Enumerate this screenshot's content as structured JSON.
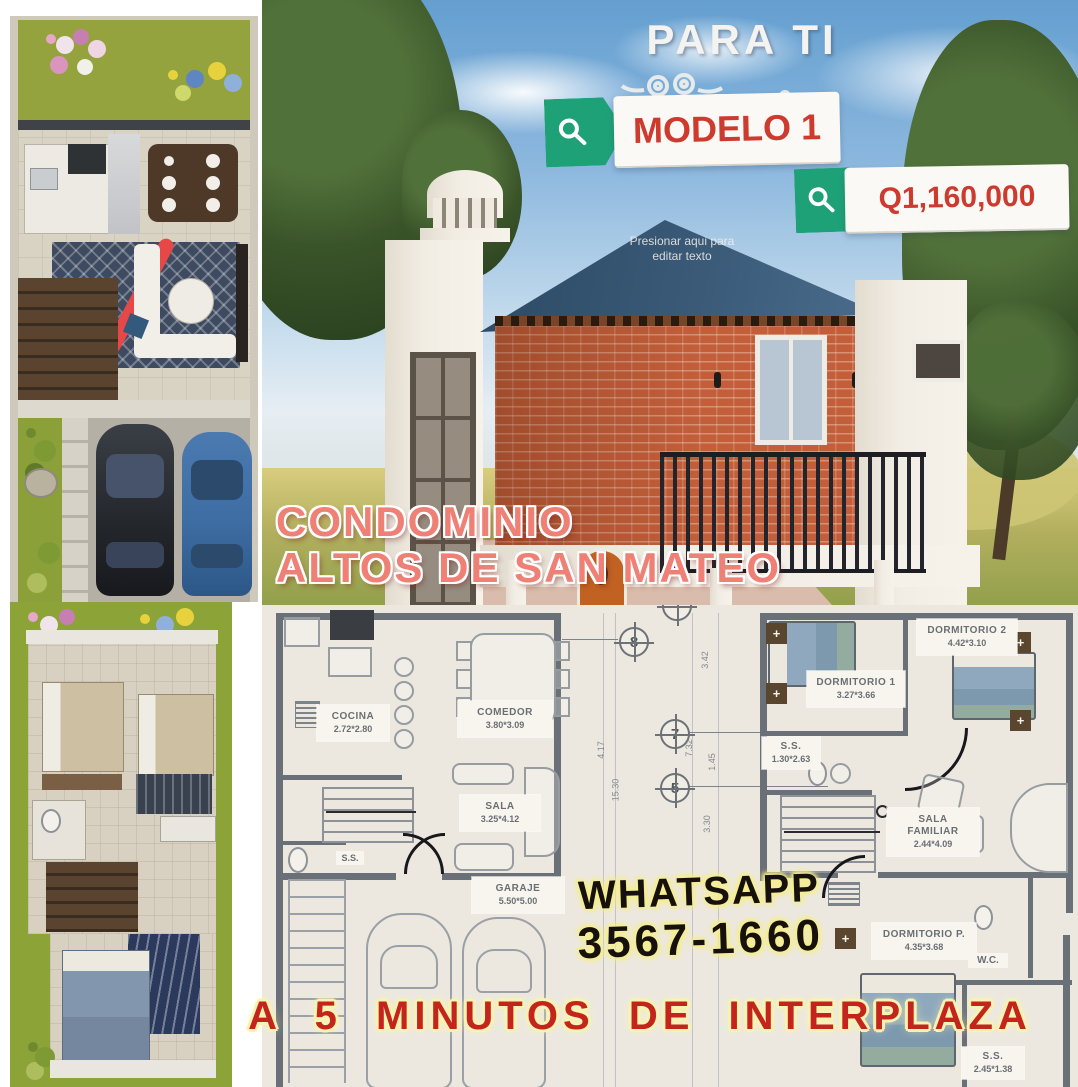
{
  "overlay": {
    "headline": "PARA TI",
    "model_tag": "MODELO 1",
    "price_tag": "Q1,160,000",
    "edit_hint_line1": "Presionar aqui para",
    "edit_hint_line2": "editar texto",
    "condo_line1": "CONDOMINIO",
    "condo_line2": "ALTOS DE SAN MATEO",
    "whatsapp_line1": "WHATSAPP",
    "whatsapp_line2": "3567-1660",
    "bottom_banner": "A 5 MINUTOS DE INTERPLAZA"
  },
  "floor_plan": {
    "ground": {
      "rooms": [
        {
          "name": "COCINA",
          "dims": "2.72*2.80"
        },
        {
          "name": "COMEDOR",
          "dims": "3.80*3.09"
        },
        {
          "name": "SALA",
          "dims": "3.25*4.12"
        },
        {
          "name": "GARAJE",
          "dims": "5.50*5.00"
        },
        {
          "name": "S.S.",
          "dims": ""
        }
      ]
    },
    "upper": {
      "rooms": [
        {
          "name": "DORMITORIO 1",
          "dims": "3.27*3.66"
        },
        {
          "name": "DORMITORIO 2",
          "dims": "4.42*3.10"
        },
        {
          "name": "S.S.",
          "dims": "1.30*2.63"
        },
        {
          "name": "SALA FAMILIAR",
          "dims": "2.44*4.09"
        },
        {
          "name": "DORMITORIO P.",
          "dims": "4.35*3.68"
        },
        {
          "name": "W.C.",
          "dims": ""
        },
        {
          "name": "S.S.",
          "dims": "2.45*1.38"
        }
      ]
    },
    "grid_markers": [
      "8",
      "7",
      "5"
    ],
    "dimensions": [
      "4.17",
      "15.30",
      "3.42",
      "7.32",
      "1.45",
      "3.30"
    ]
  },
  "colors": {
    "tag-green": "#1fa177",
    "tag-text-red": "#cd3a2e",
    "condo-pink": "#ef8076",
    "banner-red": "#c3241e",
    "glow-yellow": "#f6ee8d",
    "brick-orange": "#c25f3a",
    "roof-blue": "#304d68",
    "plan-wall-gray": "#6a7077",
    "plan-bg": "#ece8e0"
  }
}
